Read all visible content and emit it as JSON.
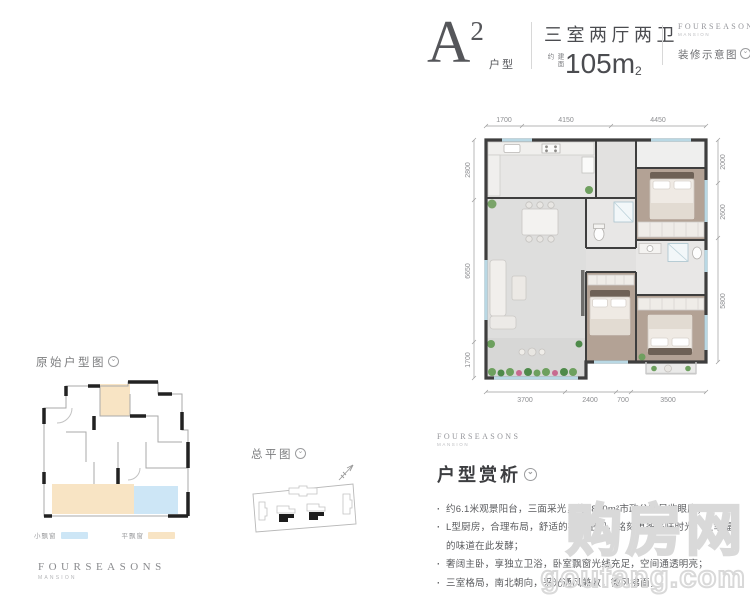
{
  "header": {
    "unit_letter": "A",
    "unit_sup": "2",
    "unit_label": "户型",
    "spec_rooms": "三室两厅两卫",
    "area_prefix": "建面约",
    "area_value": "105m",
    "area_sup": "2",
    "brand_name": "FOURSEASONS",
    "brand_sub": "MANSION",
    "note": "装修示意图"
  },
  "floorplan": {
    "dims_top": [
      "1700",
      "4150",
      "4450"
    ],
    "dims_bottom": [
      "3700",
      "2400",
      "700",
      "3500"
    ],
    "dims_left": [
      "2800",
      "6650",
      "1700"
    ],
    "dims_right": [
      "2000",
      "2600",
      "5800"
    ]
  },
  "original_plan": {
    "title": "原始户型图",
    "legend": [
      {
        "label": "小飘窗",
        "color": "#cde6f6"
      },
      {
        "label": "平飘窗",
        "color": "#f8e4c4"
      }
    ]
  },
  "site_plan": {
    "title": "总平图"
  },
  "analysis": {
    "brand_name": "FOURSEASONS",
    "brand_sub": "MANSION",
    "title": "户型赏析",
    "bullets": [
      "约6.1米观景阳台，三面采光，约4800m²市政公园尽收眼底；",
      "L型厨房，合理布局，舒适的操作空间，铭刻更多美味时光，让幸福的味道在此发酵；",
      "奢阔主卧，享独立卫浴，卧室飘窗光线充足，空间通透明亮；",
      "三室格局，南北朝向，采光通风兼收，微风拂面，"
    ]
  },
  "footer": {
    "brand_name": "FOURSEASONS",
    "brand_sub": "MANSION"
  },
  "watermark": {
    "cn": "购房网",
    "en": "goufang.com"
  },
  "colors": {
    "wall": "#3e3e3e",
    "wood_floor": "#b3a295",
    "tile_floor": "#e2e2e2"
  }
}
